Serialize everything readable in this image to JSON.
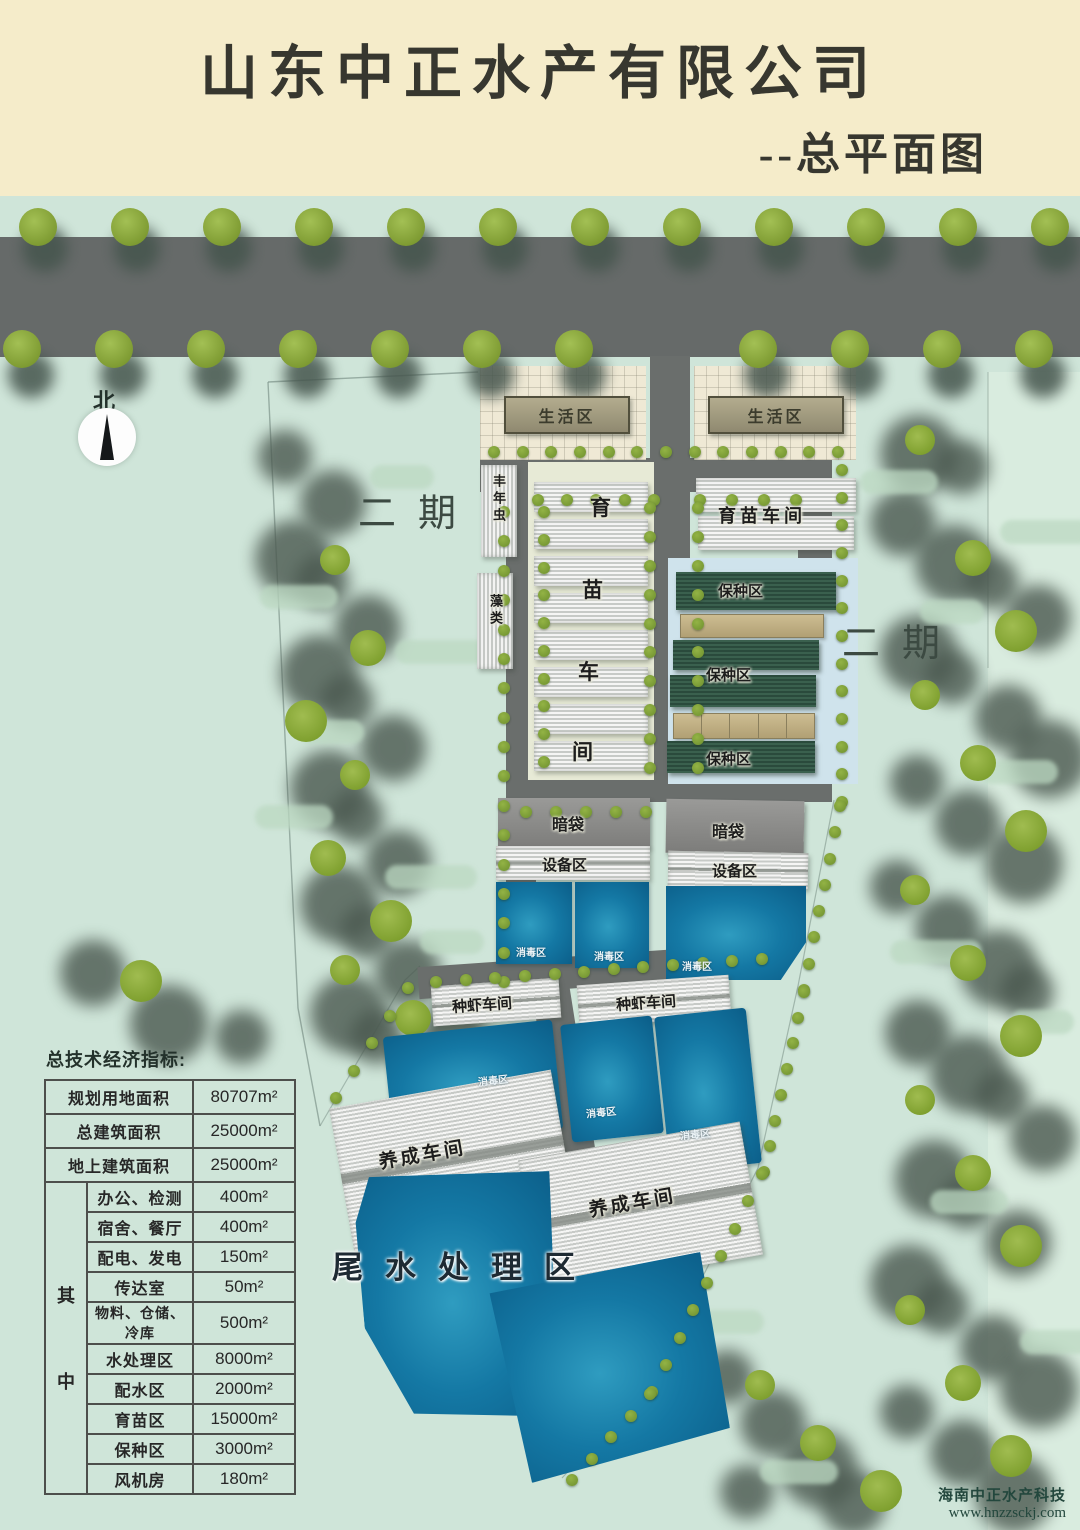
{
  "title": {
    "company": "山东中正水产有限公司",
    "subtitle": "--总平面图"
  },
  "compass": {
    "label": "北"
  },
  "phase_labels": {
    "left": "二期",
    "right": "二期"
  },
  "plan": {
    "living_areas": [
      "生活区",
      "生活区"
    ],
    "artemia_room": "丰年虫",
    "algae_room": "藻类",
    "nursery_chars": [
      "育",
      "苗",
      "车",
      "间"
    ],
    "nursery_workshop": "育苗车间",
    "broodstock": [
      "保种区",
      "保种区",
      "保种区"
    ],
    "dark_bags": [
      "暗袋",
      "暗袋"
    ],
    "equipment": [
      "设备区",
      "设备区"
    ],
    "disinfection": [
      "消毒区",
      "消毒区",
      "消毒区",
      "消毒区",
      "消毒区",
      "消毒区"
    ],
    "shrimp_workshops": [
      "种虾车间",
      "种虾车间"
    ],
    "growout_workshops": [
      "养成车间",
      "养成车间"
    ],
    "tailwater_area": "尾水处理区"
  },
  "table": {
    "title": "总技术经济指标:",
    "rows_main": [
      {
        "label": "规划用地面积",
        "value": "80707m²"
      },
      {
        "label": "总建筑面积",
        "value": "25000m²"
      },
      {
        "label": "地上建筑面积",
        "value": "25000m²"
      }
    ],
    "group_label_top": "其",
    "group_label_bottom": "中",
    "rows_sub": [
      {
        "label": "办公、检测",
        "value": "400m²"
      },
      {
        "label": "宿舍、餐厅",
        "value": "400m²"
      },
      {
        "label": "配电、发电",
        "value": "150m²"
      },
      {
        "label": "传达室",
        "value": "50m²"
      },
      {
        "label": "物料、仓储、冷库",
        "value": "500m²"
      },
      {
        "label": "水处理区",
        "value": "8000m²"
      },
      {
        "label": "配水区",
        "value": "2000m²"
      },
      {
        "label": "育苗区",
        "value": "15000m²"
      },
      {
        "label": "保种区",
        "value": "3000m²"
      },
      {
        "label": "风机房",
        "value": "180m²"
      }
    ]
  },
  "watermark": {
    "line1": "海南中正水产科技",
    "line2": "www.hnzzsckj.com"
  },
  "colors": {
    "title_band": "#f5ecca",
    "map_background": "#cfe5d9",
    "road": "#666a69",
    "tree_green": "#7f9c33",
    "pond_blue": "#1478a4",
    "broodstock_green": "#2a4a3c",
    "paved": "#efe9d5",
    "building_tan": "#9a9478",
    "table_border": "#4d4f4c"
  }
}
